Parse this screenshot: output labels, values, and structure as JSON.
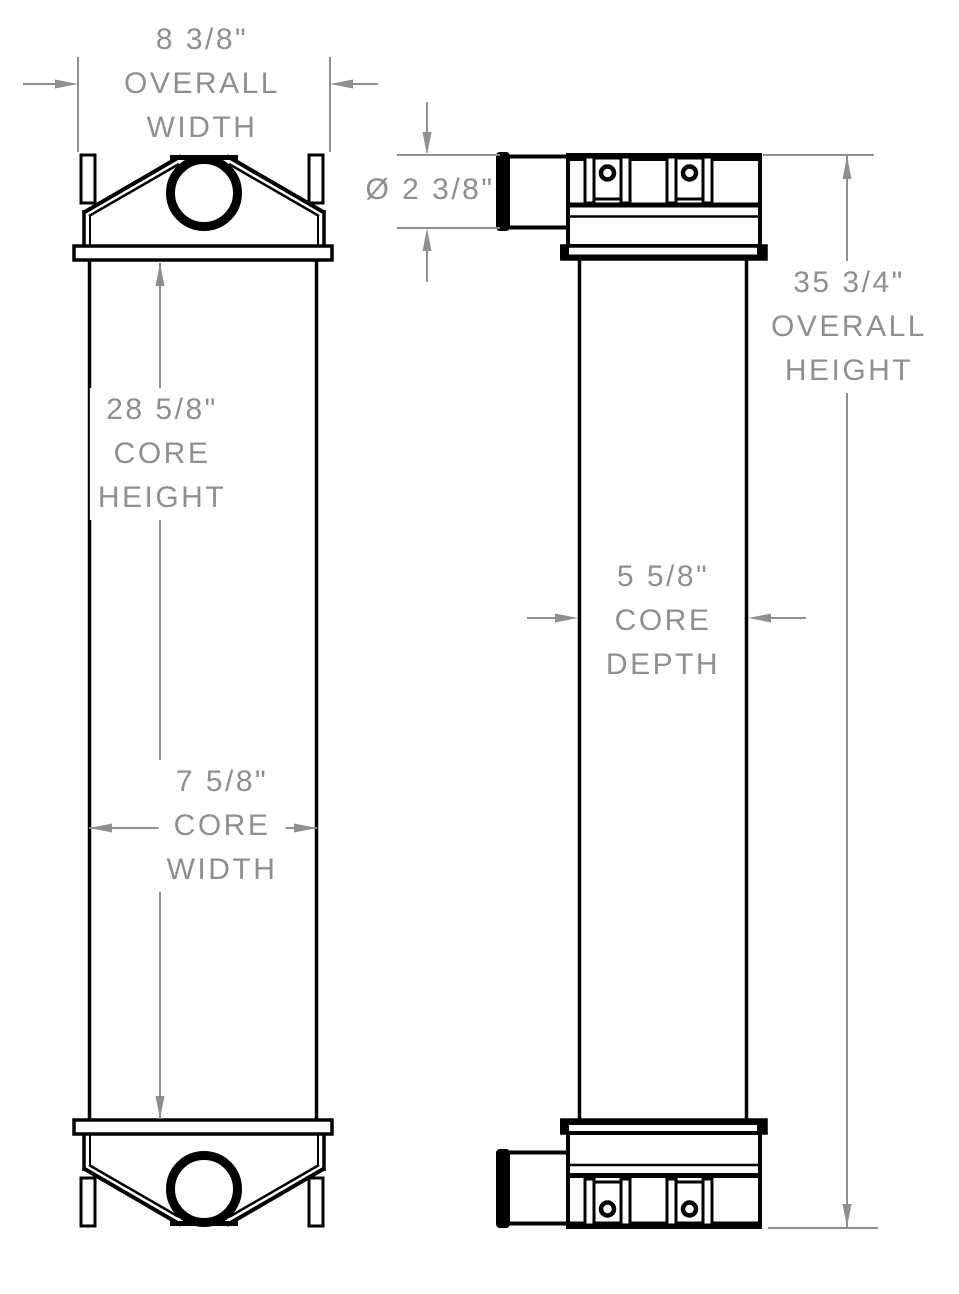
{
  "colors": {
    "background": "#ffffff",
    "outline": "#000000",
    "dimension": "#8f8f8f"
  },
  "dimensions": {
    "overall_width": {
      "value_in": 8.375,
      "lines": [
        "8 3/8\"",
        "OVERALL",
        "WIDTH"
      ]
    },
    "port_diameter": {
      "value_in": 2.375,
      "lines": [
        "Ø 2 3/8\""
      ]
    },
    "overall_height": {
      "value_in": 35.75,
      "lines": [
        "35 3/4\"",
        "OVERALL",
        "HEIGHT"
      ]
    },
    "core_height": {
      "value_in": 28.625,
      "lines": [
        "28 5/8\"",
        "CORE",
        "HEIGHT"
      ]
    },
    "core_depth": {
      "value_in": 5.625,
      "lines": [
        "5 5/8\"",
        "CORE",
        "DEPTH"
      ]
    },
    "core_width": {
      "value_in": 7.625,
      "lines": [
        "7 5/8\"",
        "CORE",
        "WIDTH"
      ]
    }
  }
}
